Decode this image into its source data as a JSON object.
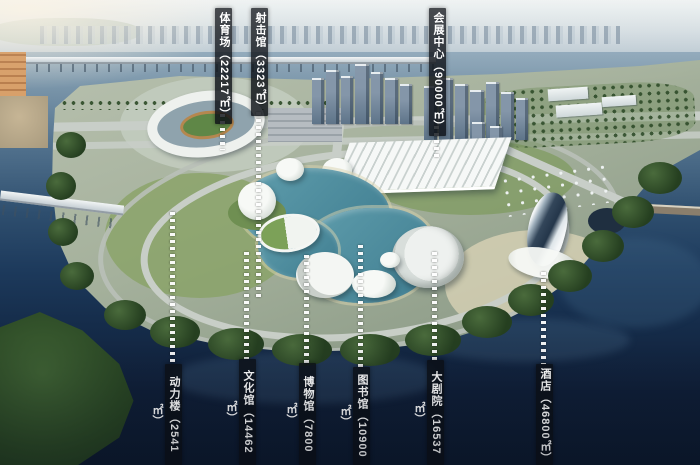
{
  "scene": {
    "description": "Aerial rendering of riverside cultural and sports district master plan with area callouts",
    "colors": {
      "label_bar_bg": "#0c1016d1",
      "label_text": "#ffffff",
      "leader_dash": "#ffffff",
      "lagoon": "#4f8ba0",
      "deep_water": "#0f2038",
      "river": "#8ba6b6",
      "land": "#a5b19c",
      "tree_green": "#2c4a26"
    },
    "labels": {
      "top": [
        {
          "building": "体育场",
          "area_sqm": "22217",
          "text": "体育场（22217㎡）"
        },
        {
          "building": "射击馆",
          "area_sqm": "3323",
          "text": "射击馆（3323㎡）"
        },
        {
          "building": "会展中心",
          "area_sqm": "90000",
          "text": "会展中心（90000㎡）"
        }
      ],
      "bottom": [
        {
          "building": "动力楼",
          "area_sqm": "2541",
          "text": "动力楼（2541㎡）"
        },
        {
          "building": "文化馆",
          "area_sqm": "14462",
          "text": "文化馆（14462㎡）"
        },
        {
          "building": "博物馆",
          "area_sqm": "7800",
          "text": "博物馆（7800㎡）"
        },
        {
          "building": "图书馆",
          "area_sqm": "10900",
          "text": "图书馆（10900㎡）"
        },
        {
          "building": "大剧院",
          "area_sqm": "16537",
          "text": "大剧院（16537㎡）"
        },
        {
          "building": "酒店",
          "area_sqm": "46800",
          "text": "酒店（46800㎡）"
        }
      ]
    }
  }
}
